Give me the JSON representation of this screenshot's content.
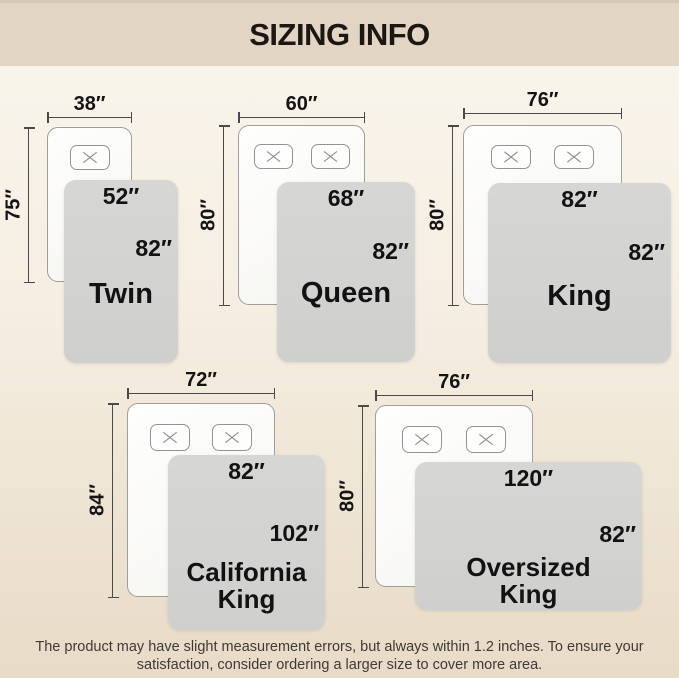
{
  "title": "SIZING INFO",
  "footer": {
    "line1": "The product may have slight measurement errors, but always within 1.2 inches. To ensure your",
    "line2": "satisfaction, consider ordering a larger size to cover more area."
  },
  "colors": {
    "header_band": "#e2d5c4",
    "page_top": "#faf6ee",
    "page_bottom": "#e8dbc7",
    "blanket_gray": "#d2d2d2",
    "mattress_white": "#fbfaf8",
    "measure_line": "#4a4a4a",
    "text_dark": "#141414"
  },
  "diagrams": [
    {
      "name_lines": [
        "Twin"
      ],
      "mattress_width": "38″",
      "mattress_length": "75″",
      "blanket_width": "52″",
      "blanket_length": "82″",
      "pillow_count": 1
    },
    {
      "name_lines": [
        "Queen"
      ],
      "mattress_width": "60″",
      "mattress_length": "80″",
      "blanket_width": "68″",
      "blanket_length": "82″",
      "pillow_count": 2
    },
    {
      "name_lines": [
        "King"
      ],
      "mattress_width": "76″",
      "mattress_length": "80″",
      "blanket_width": "82″",
      "blanket_length": "82″",
      "pillow_count": 2
    },
    {
      "name_lines": [
        "California",
        "King"
      ],
      "mattress_width": "72″",
      "mattress_length": "84″",
      "blanket_width": "82″",
      "blanket_length": "102″",
      "pillow_count": 2
    },
    {
      "name_lines": [
        "Oversized",
        "King"
      ],
      "mattress_width": "76″",
      "mattress_length": "80″",
      "blanket_width": "120″",
      "blanket_length": "82″",
      "pillow_count": 2
    }
  ]
}
